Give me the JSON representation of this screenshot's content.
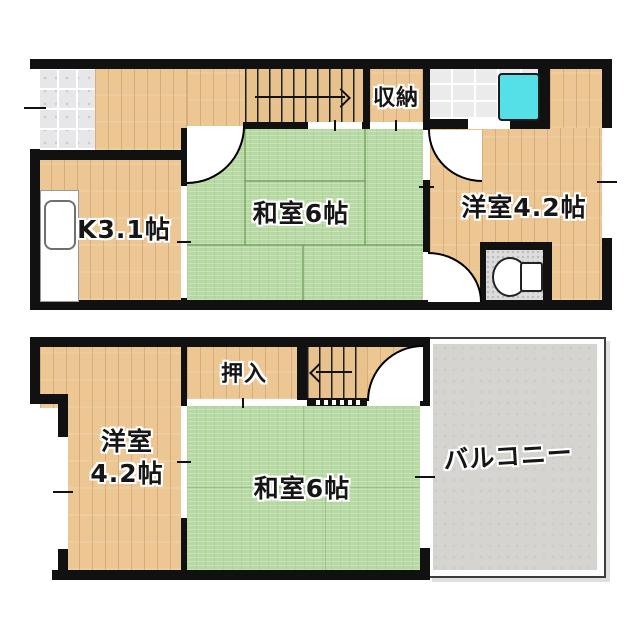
{
  "title": "two-story floor plan",
  "colors": {
    "wall": "#111111",
    "wood": "#ecc794",
    "tatami": "#b7d9a3",
    "tile_entrance": "#e7e7ea",
    "tile_bath": "#ebebeb",
    "tile_toilet": "#dcdcdc",
    "bathtub": "#55e0e8",
    "balcony": "#d5d4d0",
    "background": "#ffffff"
  },
  "floors": [
    {
      "rooms": [
        {
          "id": "kitchen",
          "label": "K3.1帖"
        },
        {
          "id": "washitsu",
          "label": "和室6帖"
        },
        {
          "id": "youshitsu",
          "label": "洋室4.2帖"
        },
        {
          "id": "shuunou",
          "label": "収納"
        }
      ]
    },
    {
      "rooms": [
        {
          "id": "oshiire",
          "label": "押入"
        },
        {
          "id": "youshitsu",
          "label": "洋室",
          "label2": "4.2帖"
        },
        {
          "id": "washitsu",
          "label": "和室6帖"
        },
        {
          "id": "balcony",
          "label": "バルコニー"
        }
      ]
    }
  ]
}
